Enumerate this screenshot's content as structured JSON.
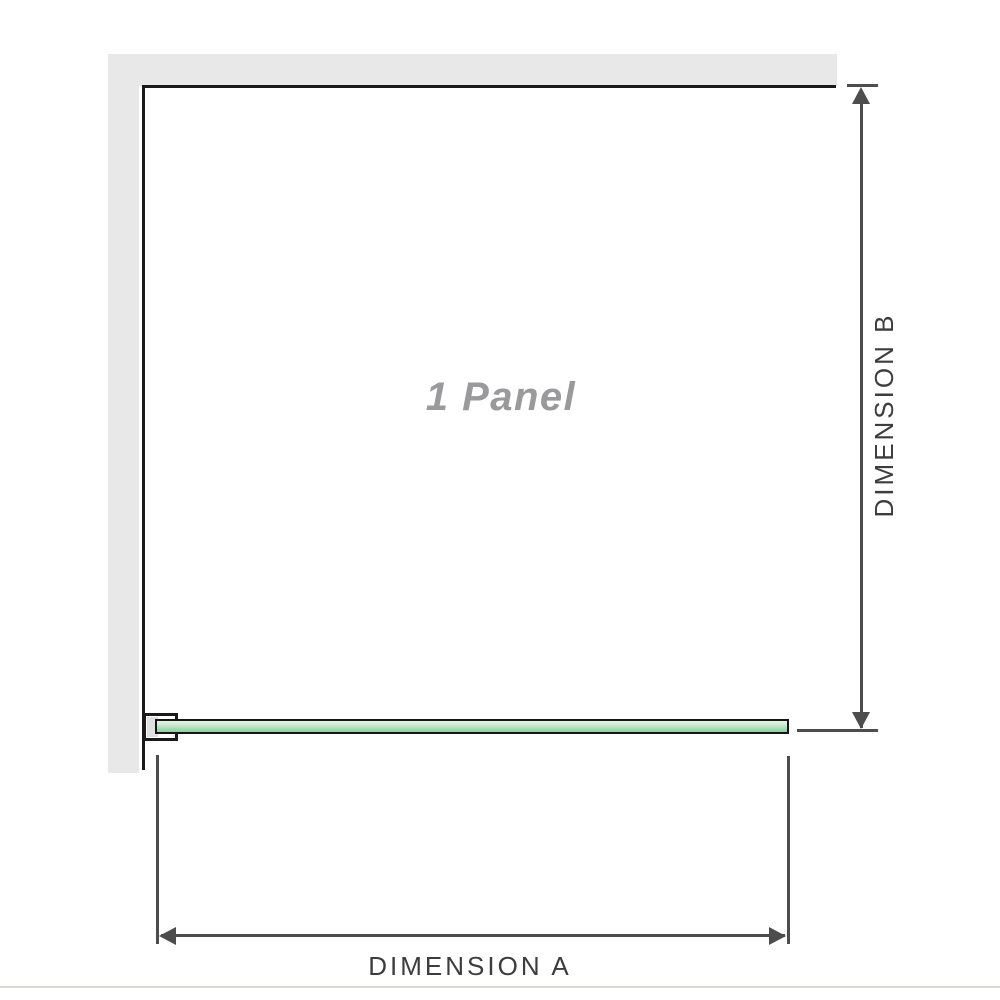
{
  "diagram": {
    "panel_label": "1 Panel",
    "dimension_a": {
      "label": "DIMENSION A"
    },
    "dimension_b": {
      "label": "DIMENSION B"
    }
  },
  "colors": {
    "wall_gray": "#e8e8e8",
    "outline_black": "#1a1a1a",
    "dim_gray": "#4d4d4d",
    "label_gray": "#3d3d3d",
    "panel_text_gray": "#9a9a9c",
    "glass_light": "#e2f3e6",
    "glass_mid": "#a5dab2",
    "glass_deep": "#8ed0a0",
    "baseline_gray": "#dbdad4"
  }
}
